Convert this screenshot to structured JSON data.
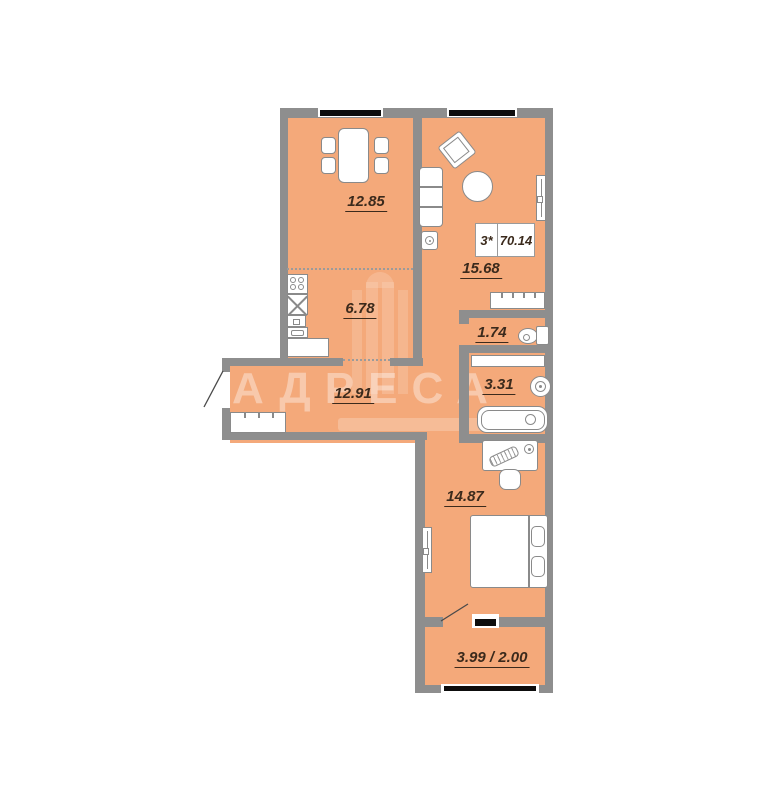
{
  "watermark": {
    "brand": "АДРЕСА"
  },
  "summary": {
    "rooms_count": "3*",
    "total_area": "70.14"
  },
  "rooms": [
    {
      "name": "dining-room",
      "area": "12.85"
    },
    {
      "name": "kitchen",
      "area": "6.78"
    },
    {
      "name": "living-room",
      "area": "15.68"
    },
    {
      "name": "wc",
      "area": "1.74"
    },
    {
      "name": "bathroom",
      "area": "3.31"
    },
    {
      "name": "hallway",
      "area": "12.91"
    },
    {
      "name": "bedroom",
      "area": "14.87"
    },
    {
      "name": "balcony",
      "area": "3.99 / 2.00"
    }
  ],
  "colors": {
    "floor": "#f4a97a",
    "wall": "#8e8e8e",
    "label_text": "#3b2a1c",
    "window": "#0d0d0d",
    "furniture_outline": "#8a8a8a"
  },
  "icons": [
    "dining-table",
    "chair",
    "stove",
    "kitchen-sink",
    "oven",
    "drawer",
    "counter",
    "armchair",
    "coffee-table",
    "sofa",
    "speaker",
    "cabinet",
    "toilet",
    "shelf",
    "washbasin",
    "bathtub",
    "wardrobe",
    "desk",
    "keyboard",
    "mouse",
    "desk-chair",
    "bed",
    "pillow",
    "radiator",
    "door-swing",
    "window"
  ]
}
